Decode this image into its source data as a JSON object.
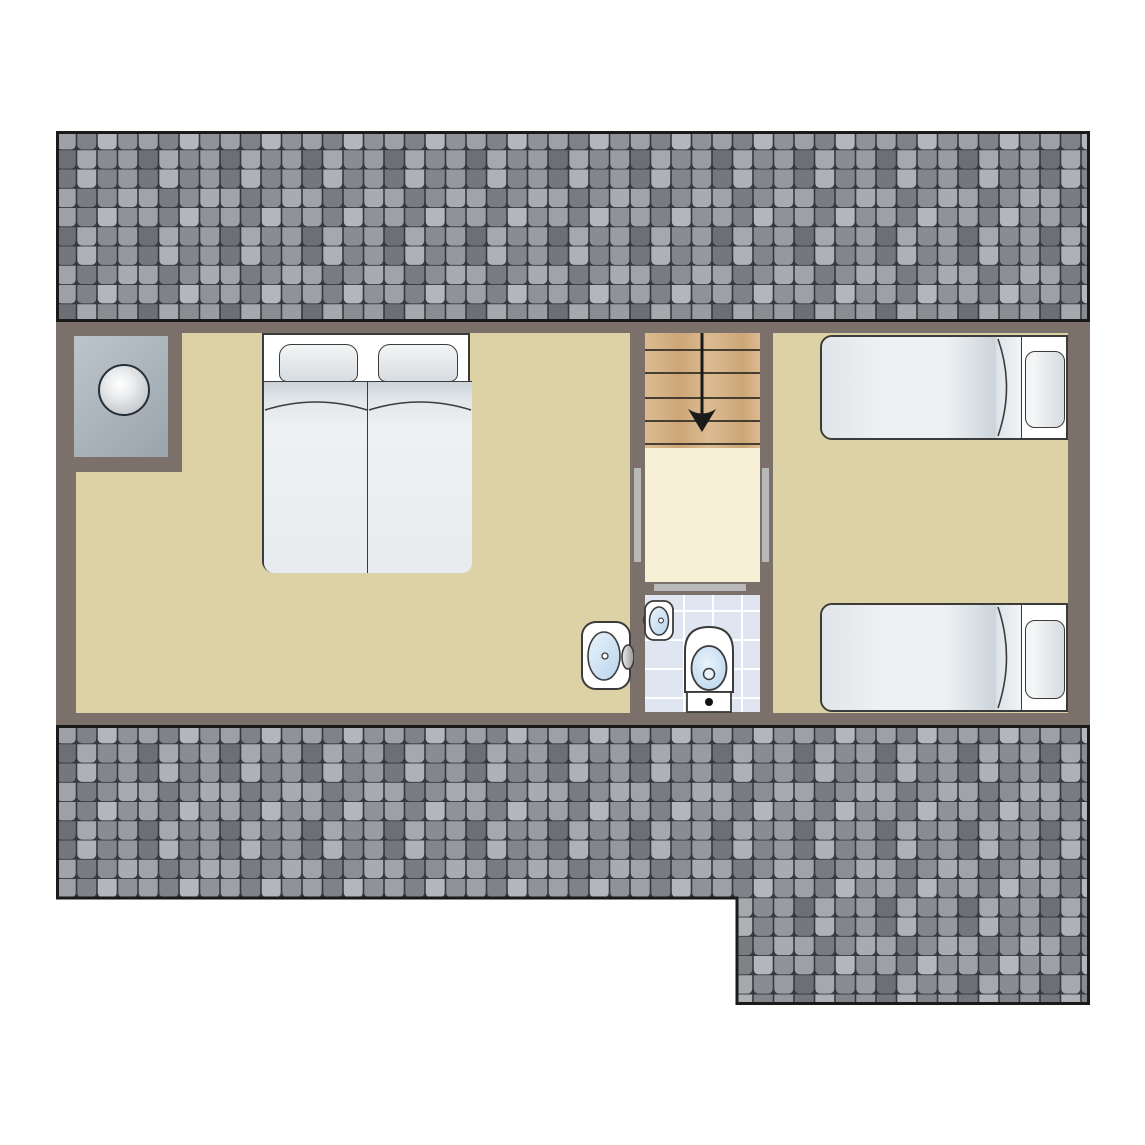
{
  "plan": {
    "type": "floor-plan",
    "level": "upper-floor",
    "rooms": [
      {
        "id": "bedroom-left",
        "furniture": [
          "chimney-flue",
          "double-bed",
          "washbasin"
        ]
      },
      {
        "id": "stairwell",
        "furniture": [
          "staircase",
          "landing"
        ],
        "stair_steps": 6,
        "stair_direction": "down"
      },
      {
        "id": "bathroom",
        "furniture": [
          "sink",
          "toilet"
        ]
      },
      {
        "id": "bedroom-right",
        "furniture": [
          "single-bed",
          "single-bed"
        ]
      }
    ],
    "doors": [
      {
        "id": "door-left-bedroom",
        "orientation": "vertical"
      },
      {
        "id": "door-right-bedroom",
        "orientation": "vertical"
      },
      {
        "id": "door-bathroom",
        "orientation": "horizontal"
      }
    ],
    "beds": {
      "double_bed_mattresses": 2,
      "double_bed_pillows": 2,
      "single_beds": 2
    },
    "roofs": [
      {
        "id": "roof-upper",
        "shape": "rectangle"
      },
      {
        "id": "roof-lower",
        "shape": "L-step"
      }
    ]
  },
  "colors": {
    "outline": "#3b3b3b",
    "roof_border": "#1a1a1a",
    "roof_gap": "#35383c",
    "tile_shades": [
      "#9da1a5",
      "#7f8387",
      "#b3b7bb",
      "#8f9397",
      "#6c7074",
      "#a5a9ad",
      "#898d91",
      "#999da1",
      "#74787c",
      "#aeb2b6",
      "#82868a",
      "#95999d",
      "#a0a4a8",
      "#787c80",
      "#8b8f93",
      "#a8acb0"
    ],
    "wall": "#7b706a",
    "floor": "#ddd1a6",
    "landing": "#f7efd6",
    "stair_wood_a": "#dcbb92",
    "stair_wood_b": "#cda678",
    "tread_line": "#473e32",
    "arrow": "#1a1a1a",
    "bath_tile": "#dfe6f1",
    "grout": "#ffffff",
    "door_marker": "#b9b9b9",
    "chimney_a": "#bcc5cb",
    "chimney_b": "#9aa4ac",
    "flue_ring": "#252e35",
    "flue_edge": "#b4bac0",
    "fixture_white": "#ffffff",
    "mattress_hi": "#eef1f3",
    "mattress_lo": "#ccd4da",
    "fold_hi": "#f2f4f6",
    "pillow_hi": "#f3f5f6",
    "pillow_lo": "#d7dce0",
    "basin_hi": "#e9f3fb",
    "basin_lo": "#b8d4ec",
    "faucet_hi": "#ececec",
    "faucet_lo": "#969696",
    "dot": "#111111"
  }
}
